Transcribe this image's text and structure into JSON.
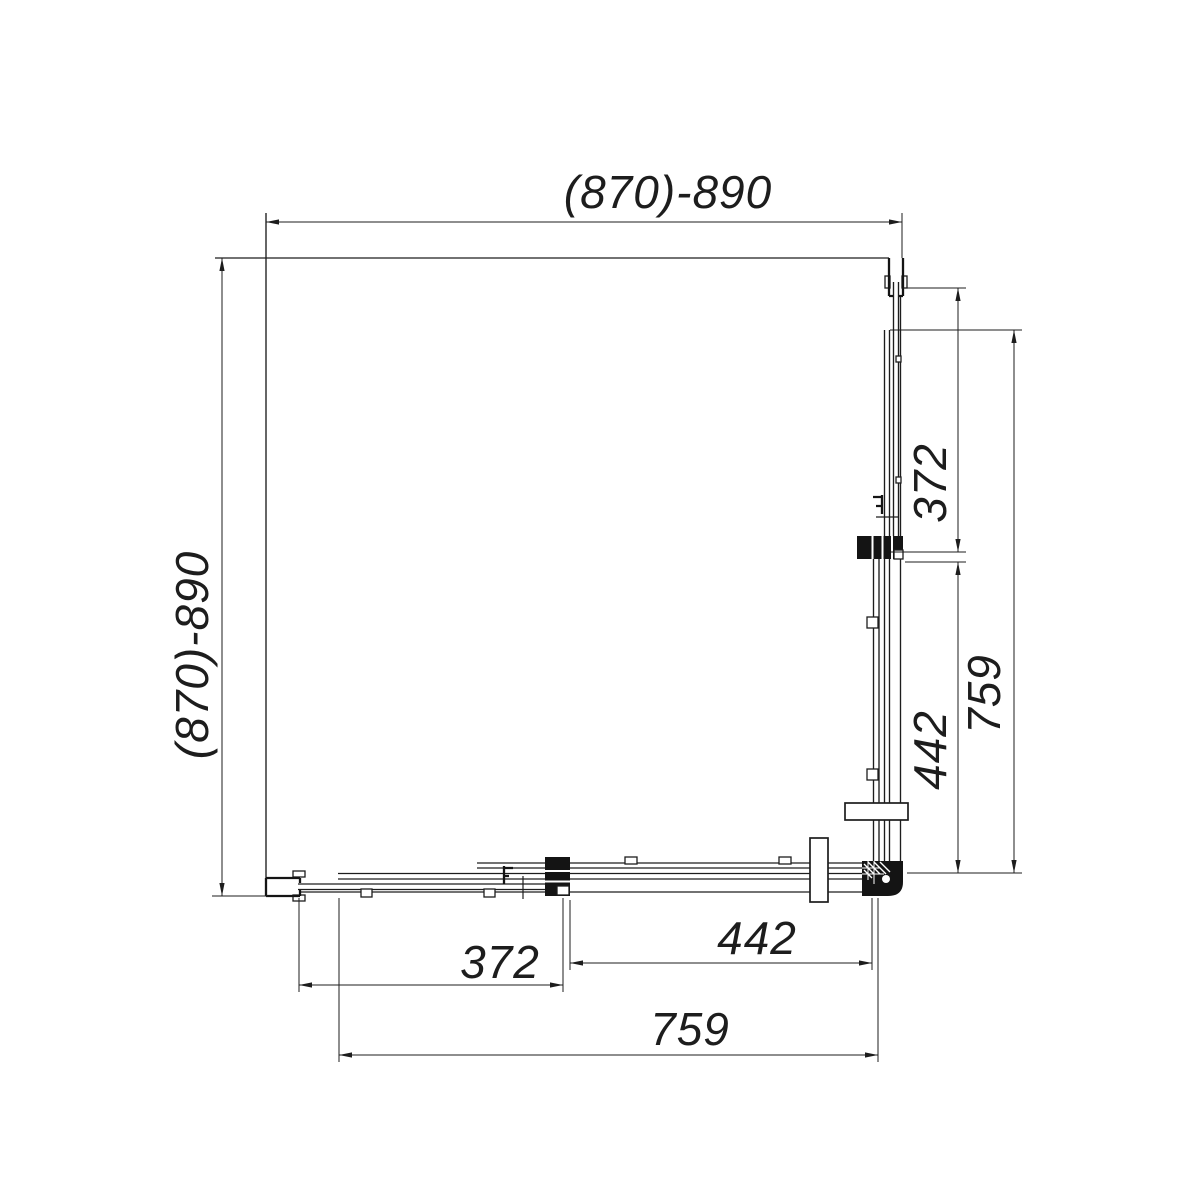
{
  "drawing": {
    "type": "technical-plan",
    "subject": "corner shower enclosure top view",
    "background": "#ffffff",
    "line_color": "#1d1d1d",
    "dimensions": {
      "top": {
        "label": "(870)-890"
      },
      "left": {
        "label": "(870)-890"
      },
      "right": [
        {
          "label": "372"
        },
        {
          "label": "442"
        },
        {
          "label": "759"
        }
      ],
      "bottom": [
        {
          "label": "372"
        },
        {
          "label": "442"
        },
        {
          "label": "759"
        }
      ]
    }
  }
}
